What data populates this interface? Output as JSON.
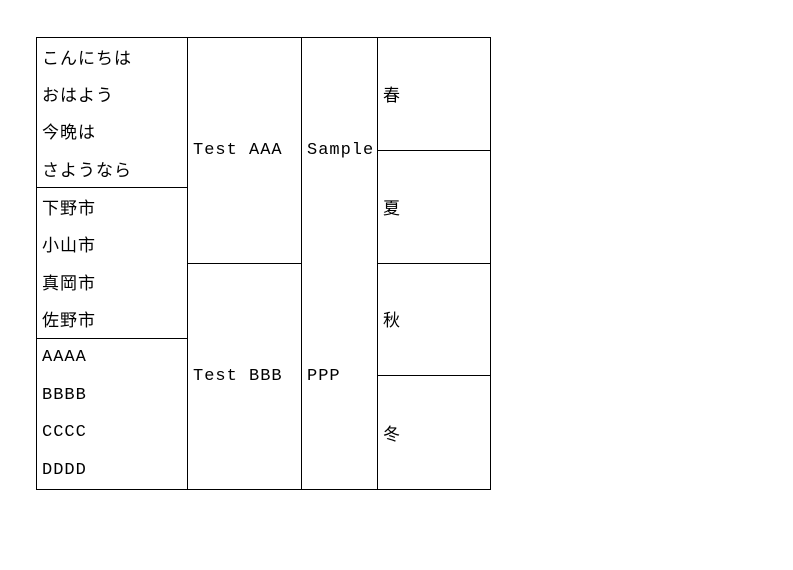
{
  "colors": {
    "background": "#ffffff",
    "border": "#000000",
    "text": "#000000"
  },
  "table": {
    "column1": {
      "cell1": {
        "lines": [
          "こんにちは",
          "おはよう",
          "今晩は",
          "さようなら"
        ]
      },
      "cell2": {
        "lines": [
          "下野市",
          "小山市",
          "真岡市",
          "佐野市"
        ]
      },
      "cell3": {
        "lines": [
          "AAAA",
          "BBBB",
          "CCCC",
          "DDDD"
        ]
      }
    },
    "column2": {
      "cell1": "Test AAA",
      "cell2": "Test BBB"
    },
    "column3": {
      "cell1": "Sample",
      "cell2": "PPP"
    },
    "column4": {
      "cell1": "春",
      "cell2": "夏",
      "cell3": "秋",
      "cell4": "冬"
    }
  }
}
